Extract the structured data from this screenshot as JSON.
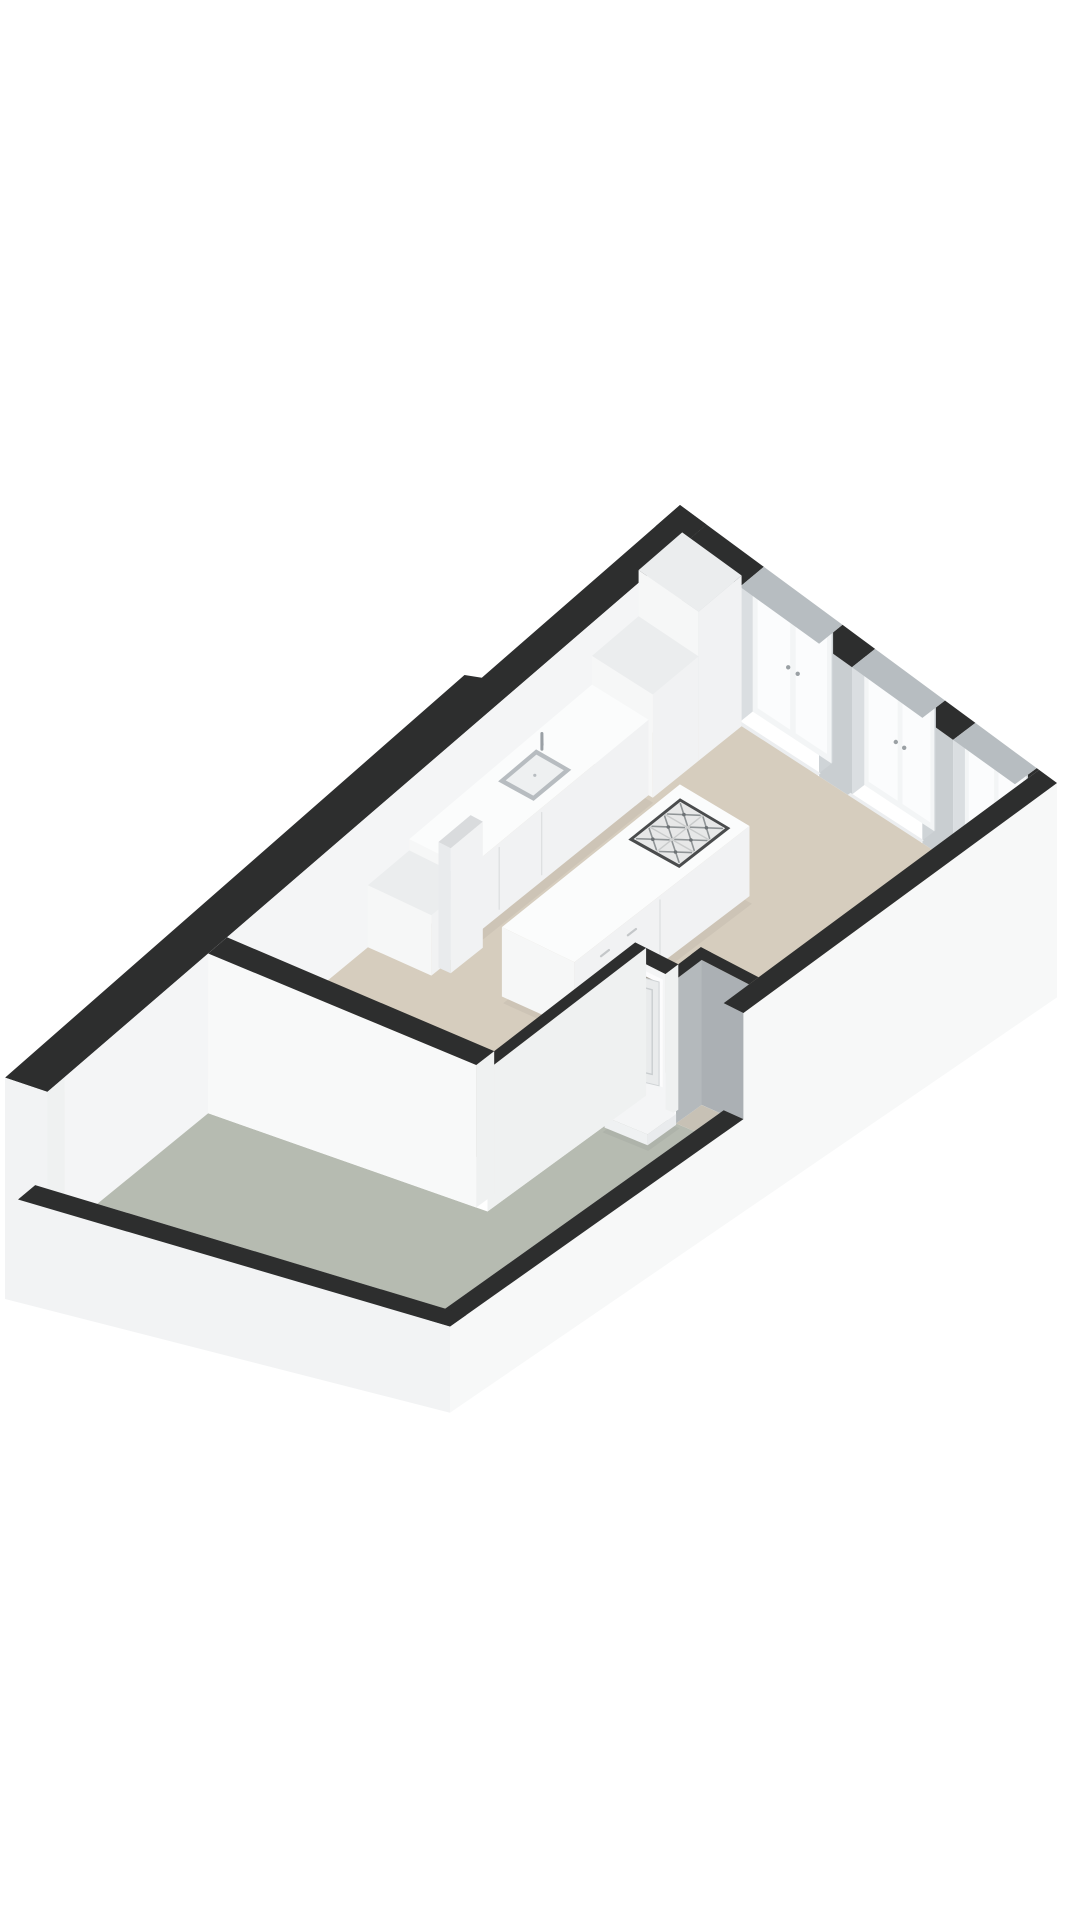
{
  "scene": {
    "kind": "isometric-3d-floor-plan",
    "background": "#ffffff",
    "rooms": [
      {
        "name": "living-room-kitchen",
        "floor": "beige"
      },
      {
        "name": "balcony-gallery",
        "floor": "gray-green"
      },
      {
        "name": "storage-closet",
        "floor": "shadowed-beige"
      }
    ],
    "objects": [
      "kitchen-tall-cabinet",
      "kitchen-mid-cabinet",
      "kitchen-counter",
      "kitchen-sink",
      "kitchen-faucet",
      "kitchen-low-cabinet",
      "partition-pillar",
      "kitchen-island",
      "cooktop-6-burner",
      "front-door",
      "door-step",
      "storage-closet",
      "french-window-1",
      "french-window-2",
      "french-window-3"
    ]
  },
  "colors": {
    "background": "#ffffff",
    "band": "#2d2e2e",
    "bandWindow": "#b7bdc1",
    "floorMain": "#d6cdbe",
    "floorBalcony": "#b6bbb1",
    "floorCloset": "#c7c1b5",
    "innerLeft": "#f4f5f6",
    "faceSouth": "#f8f9f9",
    "faceEast": "#eff1f1",
    "faceBright": "#fcfcfd",
    "fascia": "#f2f3f4",
    "fasciaBR": "#f7f8f8",
    "pier": "#c9ced1",
    "revealL": "#dadee1",
    "revealR": "#cfd4d7",
    "windowFrame": "#f3f5f6",
    "glass": "#fbfcfd",
    "sill": "#eceef0",
    "sillFace": "#e3e6e8",
    "grayWallA": "#abb0b4",
    "grayWallB": "#b4b9bc",
    "doorLeaf": "#e9ebec",
    "doorPanel": "#c9cdcf",
    "doorOpening": "#a39d92",
    "doorFrame": "#fcfcfd",
    "knob": "#9aa0a4",
    "furnTop": "#fbfcfc",
    "furnEast": "#f1f2f3",
    "furnSouth": "#f6f7f7",
    "furnTop2": "#ebedee",
    "pillarTop": "#d9dbdd",
    "seam": "#dcdedf",
    "sinkRim": "#b7bcc0",
    "sinkBasin": "#eef0f1",
    "faucet": "#9aa0a5",
    "cooktopFrame": "#4a4c4d",
    "cooktopBg": "#e7e8e8",
    "cooktopGrid": "#c9cbcb",
    "grate": "#8f9496",
    "burnerDot": "#6d7275",
    "stepTop": "#f4f5f6",
    "stepEast": "#e9ebed",
    "stepSouth": "#eff1f2",
    "sliver": "#fbfcfc",
    "shadow": "rgba(40,40,40,0.05)"
  }
}
